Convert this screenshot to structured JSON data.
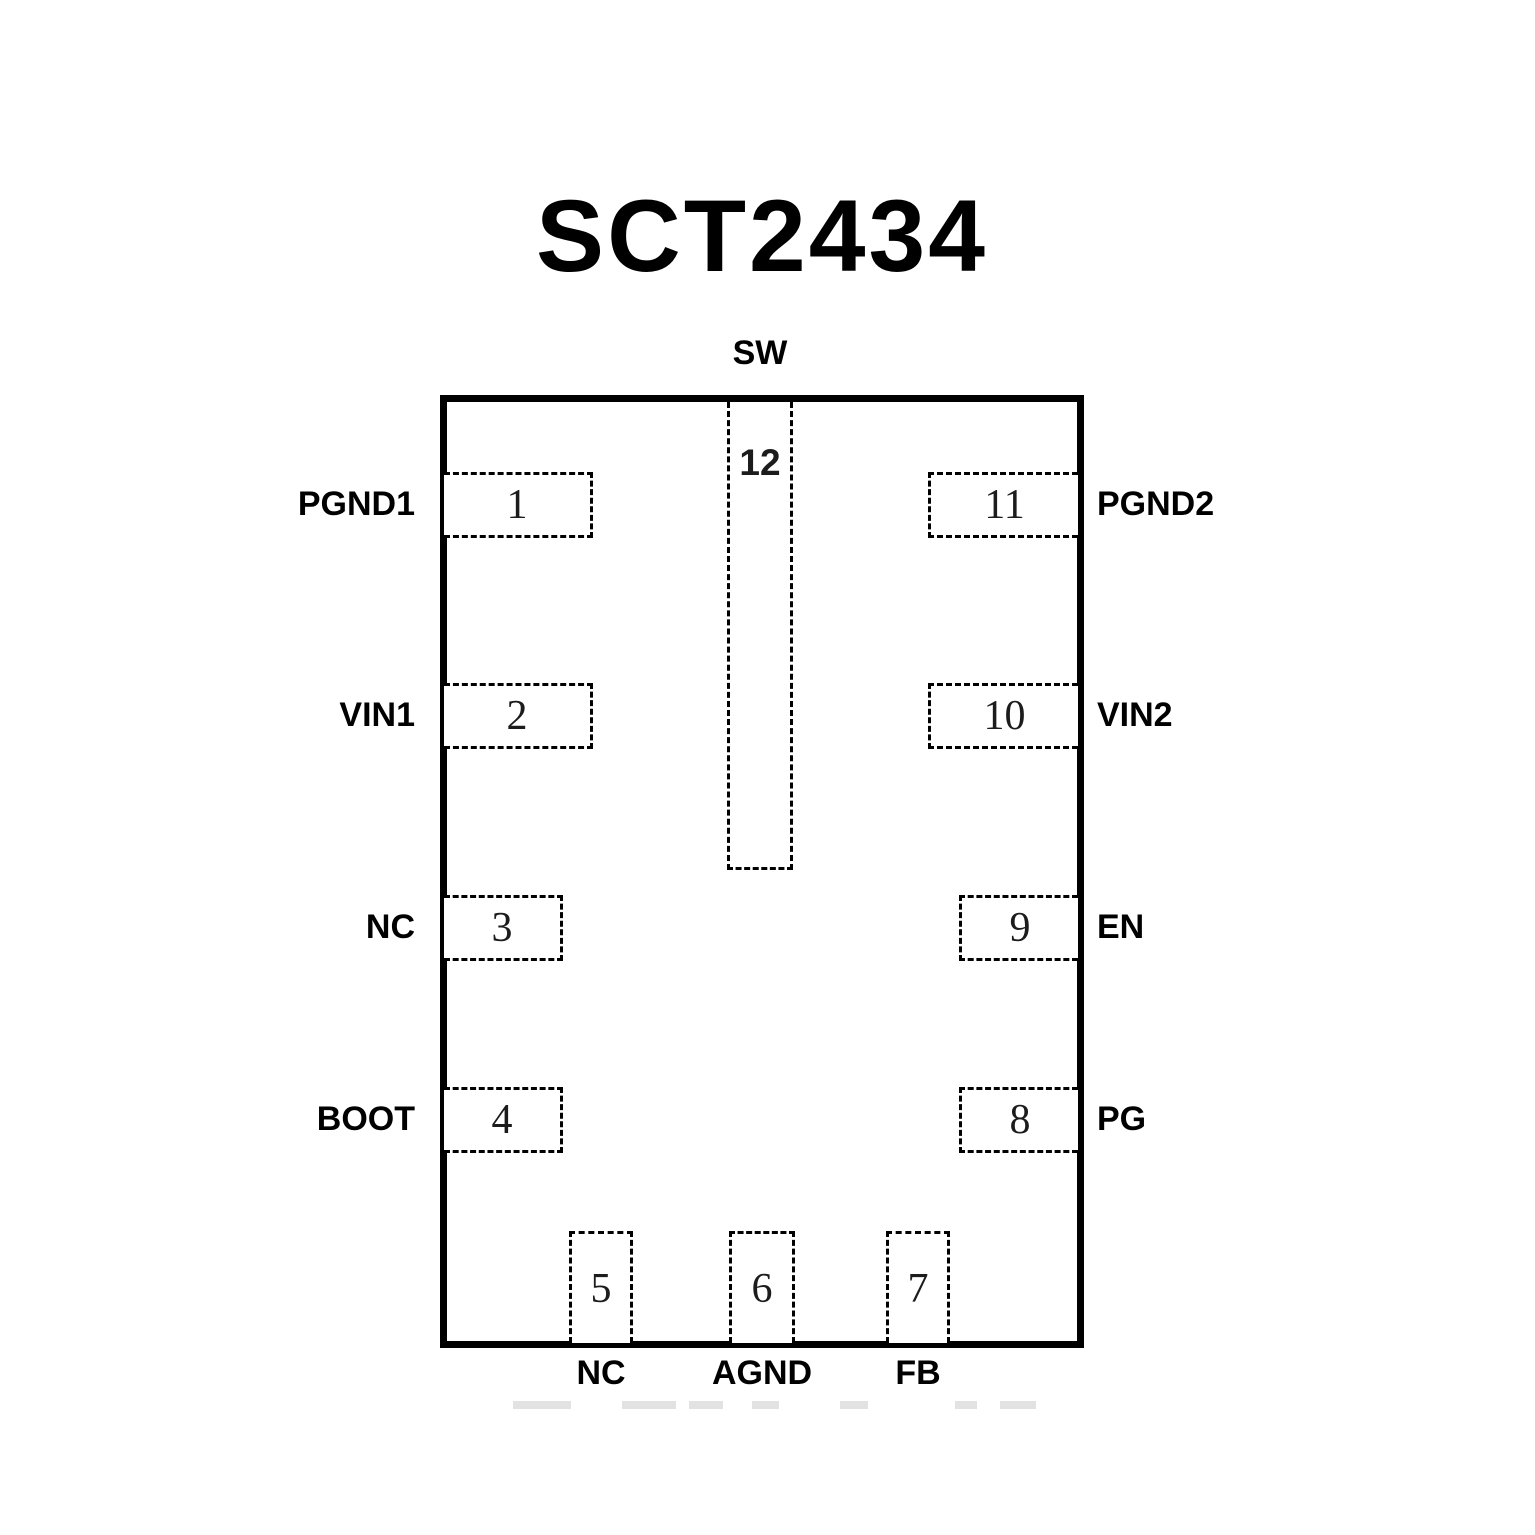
{
  "title": "SCT2434",
  "chip": {
    "top_pin": {
      "num": "12",
      "label": "SW"
    },
    "left_pins": [
      {
        "num": "1",
        "label": "PGND1"
      },
      {
        "num": "2",
        "label": "VIN1"
      },
      {
        "num": "3",
        "label": "NC"
      },
      {
        "num": "4",
        "label": "BOOT"
      }
    ],
    "right_pins": [
      {
        "num": "11",
        "label": "PGND2"
      },
      {
        "num": "10",
        "label": "VIN2"
      },
      {
        "num": "9",
        "label": "EN"
      },
      {
        "num": "8",
        "label": "PG"
      }
    ],
    "bottom_pins": [
      {
        "num": "5",
        "label": "NC"
      },
      {
        "num": "6",
        "label": "AGND"
      },
      {
        "num": "7",
        "label": "FB"
      }
    ]
  }
}
